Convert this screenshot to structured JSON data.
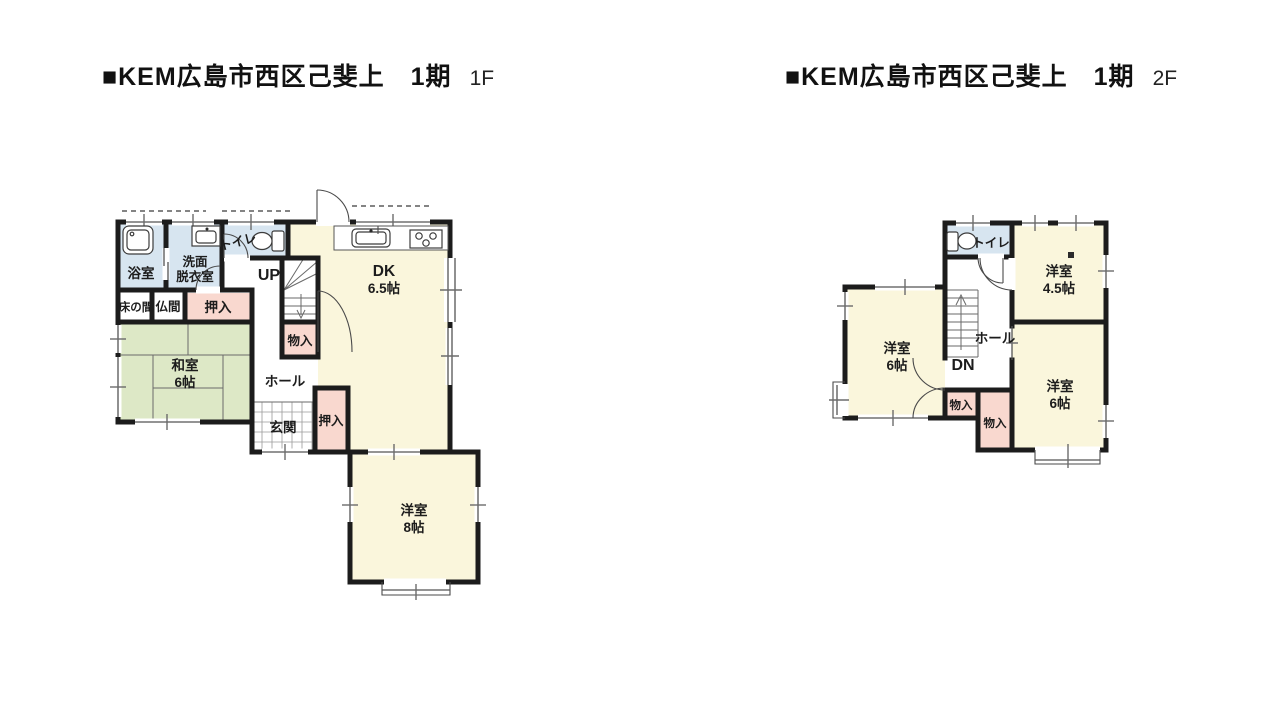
{
  "colors": {
    "wall": "#1c1c1c",
    "room_yellow": "#FAF6DC",
    "room_green": "#DDE8C6",
    "room_pink": "#F9D8CF",
    "room_blue": "#D7E5F0",
    "text": "#1c1c1c"
  },
  "floor1": {
    "title": {
      "main": "■KEM広島市西区己斐上　1期",
      "floor": "1F"
    },
    "rooms": {
      "bath": "浴室",
      "washroom_l1": "洗面",
      "washroom_l2": "脱衣室",
      "toilet": "トイレ",
      "stairs_dir": "UP",
      "dk_l1": "DK",
      "dk_l2": "6.5帖",
      "tokonoma": "床の間",
      "butsuma": "仏間",
      "oshiire_top": "押入",
      "washitsu_l1": "和室",
      "washitsu_l2": "6帖",
      "monoire": "物入",
      "hall": "ホール",
      "genkan": "玄関",
      "oshiire_entry": "押入",
      "yoshitsu8_l1": "洋室",
      "yoshitsu8_l2": "8帖"
    }
  },
  "floor2": {
    "title": {
      "main": "■KEM広島市西区己斐上　1期",
      "floor": "2F"
    },
    "rooms": {
      "toilet": "トイレ",
      "yoshitsu45_l1": "洋室",
      "yoshitsu45_l2": "4.5帖",
      "yoshitsu6w_l1": "洋室",
      "yoshitsu6w_l2": "6帖",
      "hall": "ホール",
      "stairs_dir": "DN",
      "monoire_a": "物入",
      "monoire_b": "物入",
      "yoshitsu6s_l1": "洋室",
      "yoshitsu6s_l2": "6帖"
    }
  }
}
